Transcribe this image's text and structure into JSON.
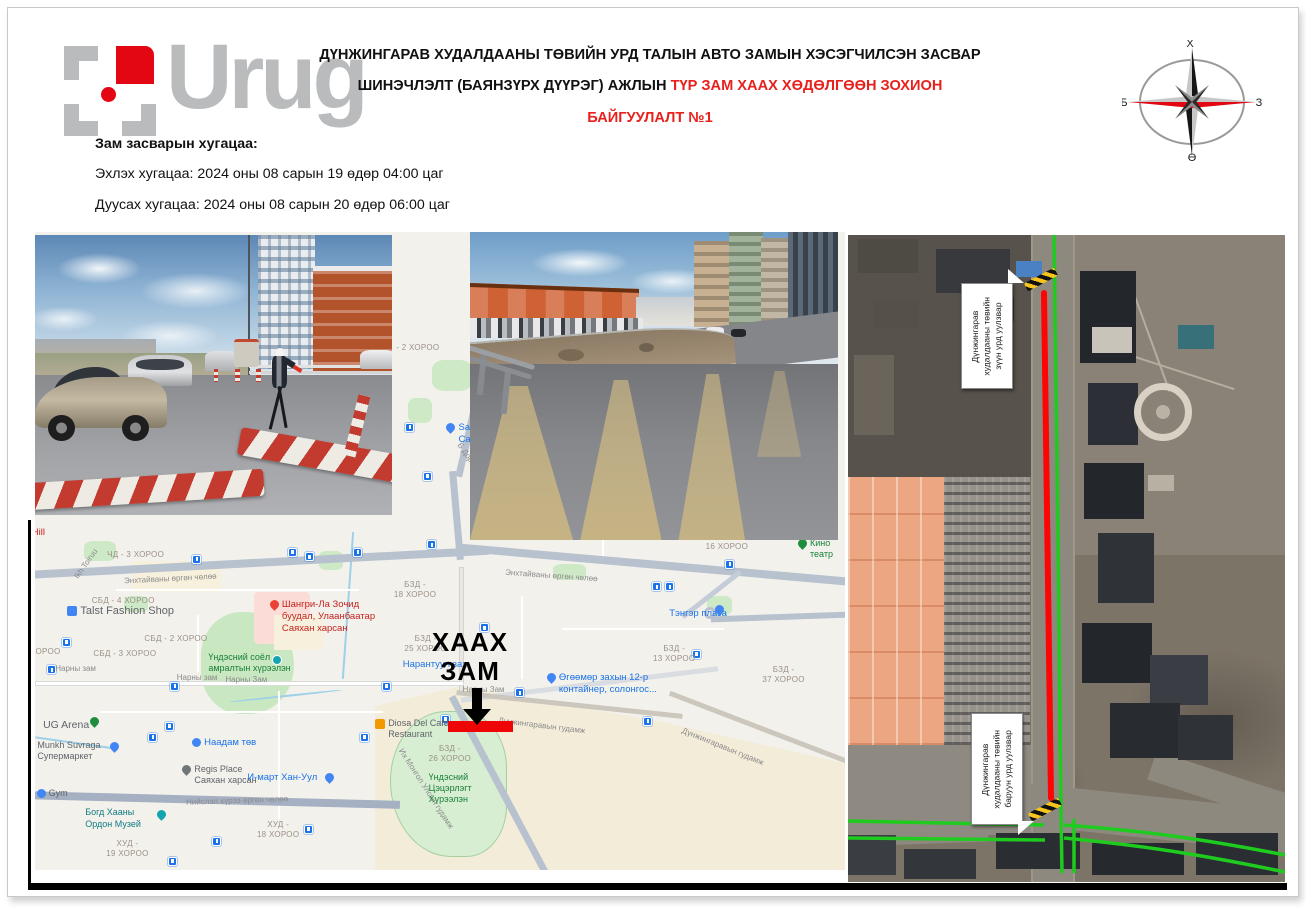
{
  "logo": {
    "text": "Urug"
  },
  "header": {
    "title_line1": "ДҮНЖИНГАРАВ ХУДАЛДААНЫ ТӨВИЙН УРД ТАЛЫН АВТО ЗАМЫН ХЭСЭГЧИЛСЭН ЗАСВАР",
    "title_line2_black": "ШИНЭЧЛЭЛТ (БАЯНЗҮРХ ДҮҮРЭГ) АЖЛЫН ",
    "title_line2_red": "ТҮР ЗАМ ХААХ ХӨДӨЛГӨӨН ЗОХИОН БАЙГУУЛАЛТ №1",
    "accent_red": "#e8211d"
  },
  "compass": {
    "n": "Х",
    "e": "З",
    "s": "Ө",
    "w": "Б"
  },
  "schedule": {
    "heading": "Зам засварын хугацаа:",
    "start": "Эхлэх хугацаа: 2024 оны 08 сарын 19 өдөр 04:00 цаг",
    "end": "Дуусах хугацаа: 2024 оны 08 сарын 20 өдөр 06:00 цаг"
  },
  "map": {
    "closure_color": "#ee0505",
    "labels": [
      {
        "t": "Hill",
        "x": -0.4,
        "y": 46.2,
        "c": "poi-red",
        "n": "map-label-hill"
      },
      {
        "t": "ЧД - 3 ХОРОО",
        "x": 8.9,
        "y": 49.8,
        "c": "area"
      },
      {
        "t": "Ikh Toiruu",
        "x": 4.2,
        "y": 51.2,
        "c": "road",
        "r": -55
      },
      {
        "t": "Энхтайваны өргөн чөлөө",
        "x": 11,
        "y": 53.6,
        "c": "road",
        "r": -3
      },
      {
        "t": "Энхтайваны өргөн чөлөө",
        "x": 58,
        "y": 53.2,
        "c": "road",
        "r": 4
      },
      {
        "t": "СБД - 4 ХОРОО",
        "x": 7,
        "y": 57,
        "c": "area"
      },
      {
        "t": "Talst Fashion Shop",
        "x": 4,
        "y": 58.4,
        "c": "poi",
        "i": "bag-blue",
        "fs": "11px"
      },
      {
        "t": "Шангри-Ла Зочид\nбуудал, Улаанбаатар\nСаяхан харсан",
        "x": 29,
        "y": 57.6,
        "c": "poi-red",
        "i": "pin-red"
      },
      {
        "t": "БЗД -\n18 ХОРОО",
        "x": 44.3,
        "y": 54.6,
        "c": "area"
      },
      {
        "t": "СБД - 2 ХОРОО",
        "x": 13.5,
        "y": 63,
        "c": "area"
      },
      {
        "t": "СБД - 3 ХОРОО",
        "x": 7.2,
        "y": 65.4,
        "c": "area"
      },
      {
        "t": "БЗД -\n25 ХОРОО",
        "x": 45.6,
        "y": 63,
        "c": "area"
      },
      {
        "t": "Нарантуул зах",
        "x": 45.4,
        "y": 66.9,
        "c": "poi-blue"
      },
      {
        "t": "ХОРОО",
        "x": -0.6,
        "y": 65.1,
        "c": "area"
      },
      {
        "t": "Нарны зам",
        "x": 2.5,
        "y": 67.7,
        "c": "road"
      },
      {
        "t": "Нарны зам",
        "x": 17.5,
        "y": 69.2,
        "c": "road"
      },
      {
        "t": "Нарны Зам",
        "x": 23.5,
        "y": 69.5,
        "c": "road"
      },
      {
        "t": "Нарны Зам",
        "x": 52.8,
        "y": 71,
        "c": "road"
      },
      {
        "t": "Үндэсний соёл\nамралтын хүрээлэн",
        "x": 21.4,
        "y": 65.8,
        "c": "poi-green"
      },
      {
        "t": "",
        "x": 29.3,
        "y": 66.2,
        "i": "circ-teal"
      },
      {
        "t": "16 ХОРОО",
        "x": 82.8,
        "y": 48.6,
        "c": "area"
      },
      {
        "t": "Кино театр",
        "x": 94.2,
        "y": 47.9,
        "c": "poi-green",
        "i": "pin-green"
      },
      {
        "t": "Тэнгэр плаза",
        "x": 78.3,
        "y": 59,
        "c": "poi-blue"
      },
      {
        "t": "",
        "x": 84,
        "y": 58.3,
        "i": "pin-blue"
      },
      {
        "t": "БЗД -\n13 ХОРОО",
        "x": 76.3,
        "y": 64.6,
        "c": "area"
      },
      {
        "t": "БЗД -\n37 ХОРОО",
        "x": 89.8,
        "y": 67.9,
        "c": "area"
      },
      {
        "t": "Өгөөмөр захын 12-р\nконтайнер, солонгос...",
        "x": 63.2,
        "y": 69,
        "c": "poi-blue",
        "i": "pin-blue"
      },
      {
        "t": "Diosa Del Cafe\nRestaurant",
        "x": 42,
        "y": 76.2,
        "c": "poi",
        "i": "sq-orange"
      },
      {
        "t": "БЗД -\n26 ХОРОО",
        "x": 48.6,
        "y": 80.3,
        "c": "area"
      },
      {
        "t": "UG Arena",
        "x": 1,
        "y": 76.3,
        "c": "poi",
        "fs": "10.5px"
      },
      {
        "t": "",
        "x": 6.8,
        "y": 75.9,
        "i": "pin-green"
      },
      {
        "t": "Munkh Suvraga\nСупермаркет",
        "x": 0.3,
        "y": 79.6,
        "c": "poi"
      },
      {
        "t": "",
        "x": 9.3,
        "y": 79.8,
        "i": "pin-blue"
      },
      {
        "t": "Наадам төв",
        "x": 19.4,
        "y": 79.2,
        "c": "poi-blue",
        "i": "circ-blue"
      },
      {
        "t": "Regis Place\nСаяхан харсан",
        "x": 18.2,
        "y": 83.4,
        "c": "poi",
        "i": "pin-gray"
      },
      {
        "t": "И-март Хан-Уул",
        "x": 26.2,
        "y": 84.6,
        "c": "poi-blue"
      },
      {
        "t": "",
        "x": 35.8,
        "y": 84.7,
        "i": "pin-blue"
      },
      {
        "t": "Gym",
        "x": 0.2,
        "y": 87.2,
        "c": "poi",
        "i": "circ-blue"
      },
      {
        "t": "Богд Хааны\nОрдон Музей",
        "x": 6.2,
        "y": 90.2,
        "c": "poi-teal"
      },
      {
        "t": "",
        "x": 15,
        "y": 90.5,
        "i": "pin-teal"
      },
      {
        "t": "ХУД -\n19 ХОРОО",
        "x": 8.8,
        "y": 95.1,
        "c": "area"
      },
      {
        "t": "ХУД -\n18 ХОРОО",
        "x": 27.4,
        "y": 92.2,
        "c": "area"
      },
      {
        "t": "Нийслэл хүрээ өргөн чөлөө",
        "x": 18.6,
        "y": 88.4,
        "c": "road",
        "r": -2
      },
      {
        "t": "Их Монгол Улсын гудамж",
        "x": 42.5,
        "y": 86.5,
        "c": "road",
        "r": 57
      },
      {
        "t": "Дүнжингаравын гудамж",
        "x": 57.2,
        "y": 76.7,
        "c": "road",
        "r": 7
      },
      {
        "t": "Дүнжингаравын гудамж",
        "x": 79.5,
        "y": 80,
        "c": "road",
        "r": 22
      },
      {
        "t": "Үндэсний\nЦэцэрлэгт\nХүрээлэн",
        "x": 48.6,
        "y": 84.6,
        "c": "poi-green"
      },
      {
        "t": "Sansar\nСаяхан харсан",
        "x": 50.8,
        "y": 29.8,
        "c": "poi-blue",
        "i": "pin-blue"
      },
      {
        "t": "Б Дорж",
        "x": 51.6,
        "y": 34.2,
        "c": "road",
        "r": 55
      },
      {
        "t": "- 2 ХОРОО",
        "x": 44.6,
        "y": 17.4,
        "c": "area"
      },
      {
        "t": "ХААХ\nЗАМ",
        "x": 49,
        "y": 62,
        "c": "big",
        "n": "closure-label"
      }
    ],
    "transit_stops": [
      [
        19.4,
        50.6
      ],
      [
        31.2,
        49.5
      ],
      [
        33.3,
        50.2
      ],
      [
        39.3,
        49.5
      ],
      [
        48.4,
        48.3
      ],
      [
        3.3,
        63.6
      ],
      [
        1.5,
        67.9
      ],
      [
        16.7,
        70.5
      ],
      [
        42.8,
        70.5
      ],
      [
        50.1,
        75.7
      ],
      [
        16,
        76.8
      ],
      [
        14,
        78.5
      ],
      [
        40.1,
        78.5
      ],
      [
        33.2,
        92.9
      ],
      [
        21.9,
        94.8
      ],
      [
        16.4,
        97.9
      ],
      [
        85.2,
        51.4
      ],
      [
        76.2,
        54.9
      ],
      [
        77.8,
        54.9
      ],
      [
        81.1,
        65.5
      ],
      [
        54.9,
        61.3
      ],
      [
        59.3,
        71.5
      ],
      [
        75.1,
        76
      ],
      [
        45.7,
        29.9
      ],
      [
        47.9,
        37.6
      ]
    ]
  },
  "satellite": {
    "closed_color": "#fe0505",
    "open_color": "#1ecb1e",
    "callouts": [
      {
        "text": "Дүнжингарав\nхудалдааны төвийн\nзүүн урд уулзвар"
      },
      {
        "text": "Дүнжингарав\nхудалдааны төвийн\nбаруун урд уулзвар"
      }
    ]
  }
}
